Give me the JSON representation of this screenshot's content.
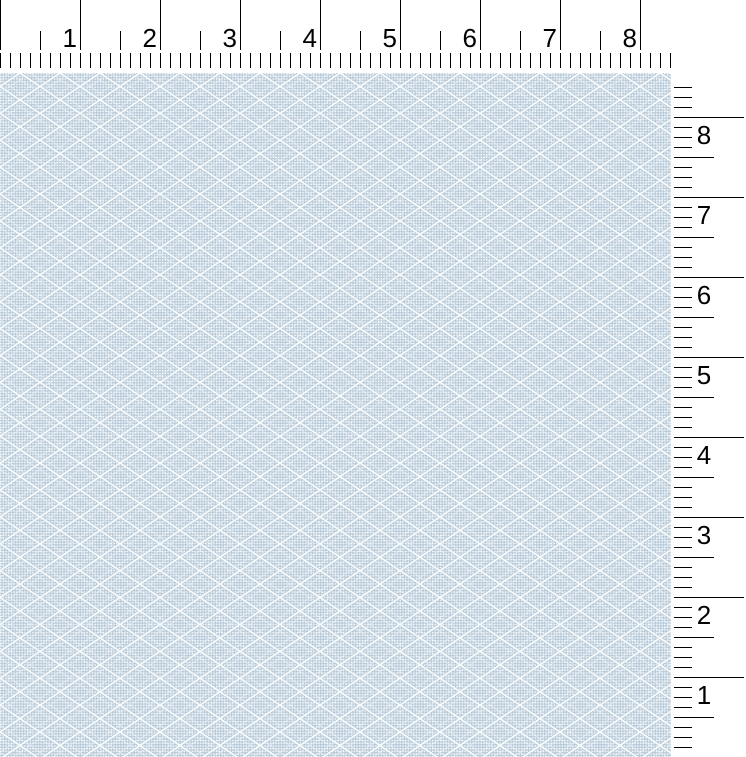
{
  "viewer": {
    "description": "Fabric swatch preview with inch rulers",
    "width_px": 746,
    "height_px": 757,
    "background": "#ffffff"
  },
  "horizontal_ruler": {
    "unit": "inch",
    "unit_labels": [
      "1",
      "2",
      "3",
      "4",
      "5",
      "6",
      "7",
      "8"
    ],
    "px_per_unit": 80,
    "minor_divisions_per_unit": 8,
    "length_px": 671,
    "height_px": 73,
    "tick_color": "#000000",
    "label_color": "#000000",
    "long_tick_span": [
      0,
      50
    ],
    "half_tick_span": [
      31,
      50
    ],
    "minor_strip_span": [
      53,
      68
    ],
    "label_baseline_y": 47
  },
  "vertical_ruler": {
    "unit": "inch",
    "unit_labels_top_to_bottom": [
      "8",
      "7",
      "6",
      "5",
      "4",
      "3",
      "2",
      "1"
    ],
    "px_per_unit": 80,
    "minor_divisions_per_unit": 8,
    "length_px": 684,
    "width_px": 75,
    "tick_color": "#000000",
    "label_color": "#000000",
    "tick_start_x": 3,
    "small_tick_end_x": 21,
    "half_tick_end_x": 43,
    "long_tick_end_x": 73,
    "label_center_x": 33,
    "label_offset_below_tick": 27
  },
  "fabric_swatch": {
    "pattern": "diamond-lattice-weave",
    "width_px": 671,
    "height_px": 684,
    "width_inches": 8.4,
    "height_inches": 8.55,
    "diamond_width_px": 40,
    "diamond_height_px": 26.9,
    "weave_cell_px": 2.7,
    "colors": {
      "base": "#c2d2df",
      "weave_light": "#ffffff",
      "weave_dark": "#a9bfd1",
      "lattice_line": "#ffffff",
      "lattice_shadow": "#a3bbce"
    }
  }
}
